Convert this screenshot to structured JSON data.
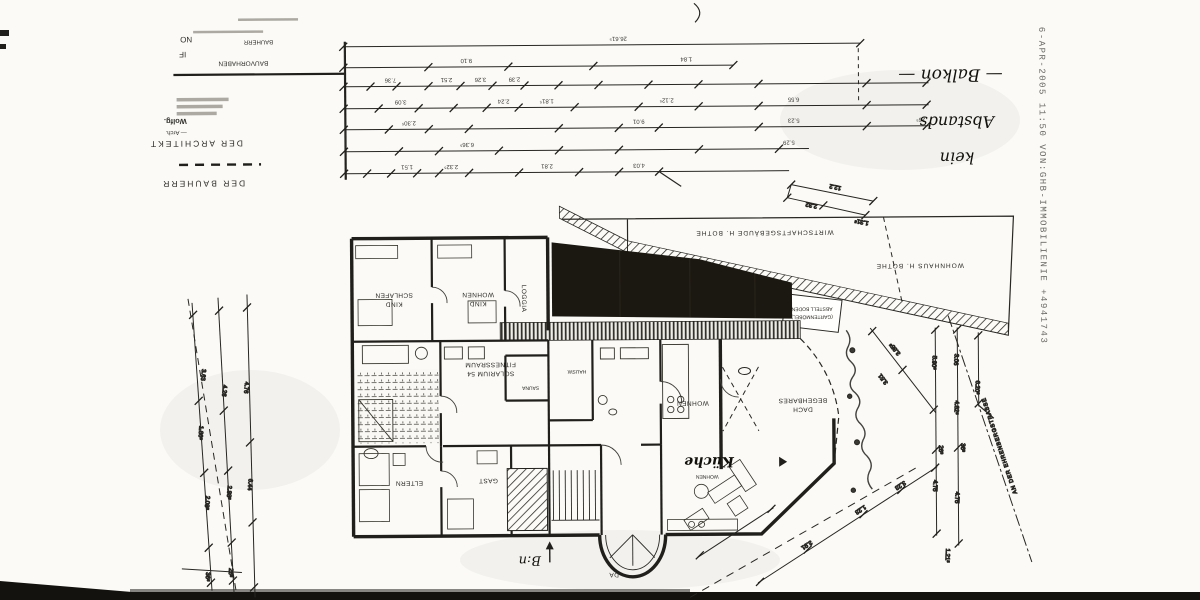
{
  "fax": {
    "header": "6-APR-2005  11:50   VON:GHB-IMMOBILIENIE   +4941743"
  },
  "title_block": {
    "frag_no": "NO",
    "frag_if": "IF",
    "bauherr_small": "BAUHERR",
    "bauvorhaben": "BAUVORHABEN",
    "arch_name": "Wolfg.",
    "arch_prefix": "— Arch.",
    "der_architekt": "DER ARCHITEKT",
    "der_bauherr": "DER BAUHERR"
  },
  "handwriting": {
    "word1": "kein",
    "word2": "Abstands",
    "word3": "— Balkon —",
    "note": "B:n"
  },
  "site": {
    "street": "AN DER EHRENBERGSTRASSE",
    "neighbor_wirtschaft": "WIRTSCHAFTSGEBÄUDE  H. BOTHE",
    "neighbor_wohnhaus": "WOHNHAUS  H. BOTHE",
    "shed_line1": "ABSTELL BODEN",
    "shed_line2": "(GARTENMÖBEL)"
  },
  "rooms": {
    "schlafen1": "SCHLAFEN",
    "schlafen2": "KIND",
    "wohnenkind1": "WOHNEN",
    "wohnenkind2": "KIND",
    "loggia": "LOGGIA",
    "fitness1": "FITNESSRAUM",
    "fitness2": "SOLARIUM 54",
    "sauna": "SAUNA",
    "hausw": "HAUSW.",
    "wohnen": "WOHNEN",
    "begeh1": "BEGEHBARES",
    "begeh2": "DACH",
    "eltern": "ELTERN",
    "gast": "GAST",
    "kueche": "Küche",
    "kueche_sub": "WOHNEN",
    "da": "DA"
  },
  "dims": [
    "26.61⁵",
    "9.10",
    "1.84",
    "7.36",
    "2.51",
    "3.26",
    "2.39",
    "3.09",
    "2.24",
    "1.81⁵",
    "2.12⁵",
    "6.55",
    "2.30⁵",
    "9.01",
    "5.23",
    "26⁵",
    "6.36⁵",
    "5.29",
    "1.51",
    "2.32⁵",
    "2.81",
    "4.03",
    "12.2",
    "2.32",
    "1.31⁵",
    "3.63",
    "1.86⁵",
    "2.08⁵",
    "4.26",
    "2.88⁵",
    "4.76",
    "6.44",
    "36⁵",
    "26⁵",
    "3.85⁵",
    "3.51",
    "5.90⁵",
    "4.75",
    "3.06",
    "4.82⁵",
    "4.75",
    "6.20³",
    "26³",
    "36³",
    "3.91",
    "1.23",
    "3.23",
    "1.21⁵"
  ]
}
